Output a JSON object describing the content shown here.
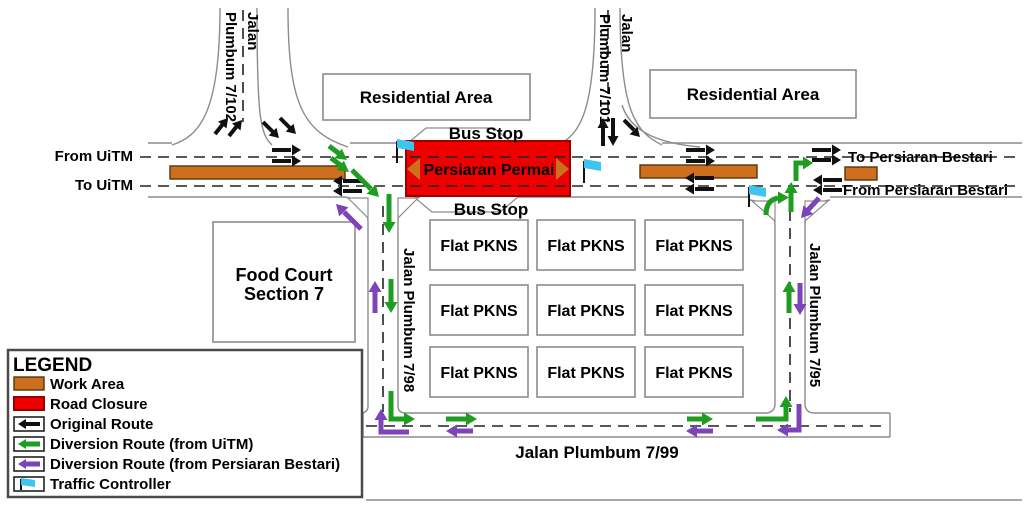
{
  "colors": {
    "work_area": "#CE6F1E",
    "work_area_border": "#54350C",
    "road_closure": "#EE0000",
    "road_closure_border": "#990000",
    "original_route": "#111111",
    "diversion_uitm": "#1F9D20",
    "diversion_bestari": "#7C44B8",
    "traffic_controller": "#3EC4EF",
    "road_edge": "#8C8C8C",
    "dash_line": "#222222",
    "building_border": "#8C8C8C",
    "legend_border": "#4A4A4A"
  },
  "legend": {
    "title": "LEGEND",
    "items": [
      {
        "label": "Work Area"
      },
      {
        "label": "Road Closure"
      },
      {
        "label": "Original Route"
      },
      {
        "label": "Diversion Route (from UiTM)"
      },
      {
        "label": "Diversion Route (from Persiaran Bestari)"
      },
      {
        "label": "Traffic Controller"
      }
    ]
  },
  "roads": {
    "plumbum_7_102_line1": "Jalan",
    "plumbum_7_102_line2": "Plumbum 7/102",
    "plumbum_7_101_line1": "Jalan",
    "plumbum_7_101_line2": "Plumbum 7/101",
    "plumbum_7_98": "Jalan Plumbum 7/98",
    "plumbum_7_95": "Jalan Plumbum 7/95",
    "plumbum_7_99": "Jalan Plumbum 7/99",
    "closed_road": "Persiaran Permai"
  },
  "directions": {
    "from_uitm": "From UiTM",
    "to_uitm": "To UiTM",
    "to_bestari": "To Persiaran Bestari",
    "from_bestari": "From Persiaran Bestari"
  },
  "places": {
    "residential": "Residential Area",
    "bus_stop": "Bus Stop",
    "food_court_line1": "Food Court",
    "food_court_line2": "Section 7",
    "flat": "Flat PKNS"
  }
}
